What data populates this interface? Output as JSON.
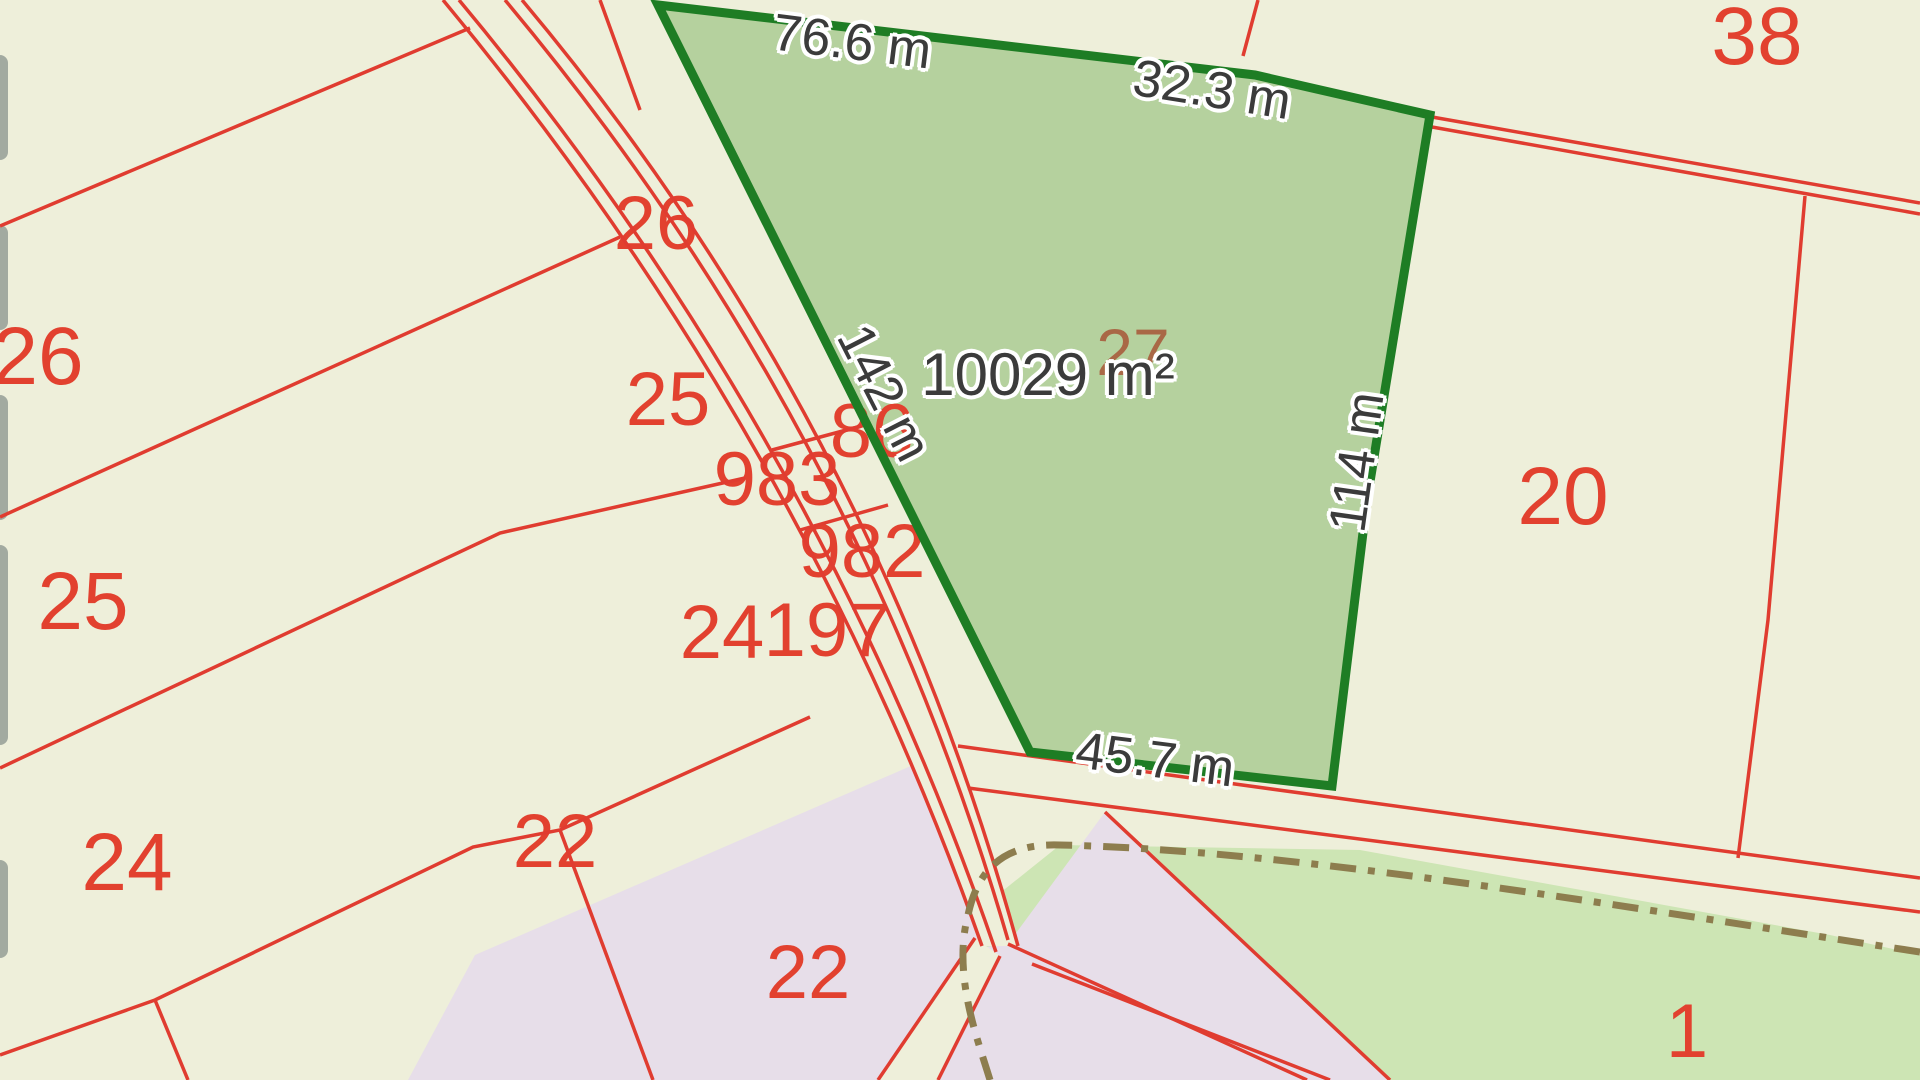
{
  "map": {
    "type": "cadastral-parcel-map",
    "selected_parcel": {
      "number": "27",
      "area": "10029 m²",
      "side_lengths": {
        "top_left": "76.6 m",
        "top_right": "32.3 m",
        "left": "142 m",
        "right": "114 m",
        "bottom": "45.7 m"
      }
    },
    "parcel_labels": [
      {
        "id": "26-upper-left",
        "text": "26"
      },
      {
        "id": "25-left",
        "text": "25"
      },
      {
        "id": "24-left",
        "text": "24"
      },
      {
        "id": "26-road",
        "text": "26"
      },
      {
        "id": "25-road",
        "text": "25"
      },
      {
        "id": "983",
        "text": "983"
      },
      {
        "id": "86",
        "text": "86"
      },
      {
        "id": "982",
        "text": "982"
      },
      {
        "id": "24-road",
        "text": "24"
      },
      {
        "id": "197",
        "text": "197"
      },
      {
        "id": "22-upper",
        "text": "22"
      },
      {
        "id": "22-lower",
        "text": "22"
      },
      {
        "id": "20",
        "text": "20"
      },
      {
        "id": "38",
        "text": "38"
      },
      {
        "id": "1",
        "text": "1"
      }
    ],
    "colors": {
      "background": "#eeefda",
      "selected_parcel_fill": "#b5d19e",
      "selected_parcel_border": "#1e7d24",
      "boundary_line_red": "#e03c30",
      "parcel_number_red": "#e2412f",
      "faded_parcel_number": "#a85a3a",
      "zone_pink": "#e7dee9",
      "zone_pale_green": "#cde5b4",
      "dashed_boundary_olive": "#8d7d4e",
      "measurement_text": "#3b3b3b",
      "edge_marker_gray": "#a2aaa0"
    }
  }
}
